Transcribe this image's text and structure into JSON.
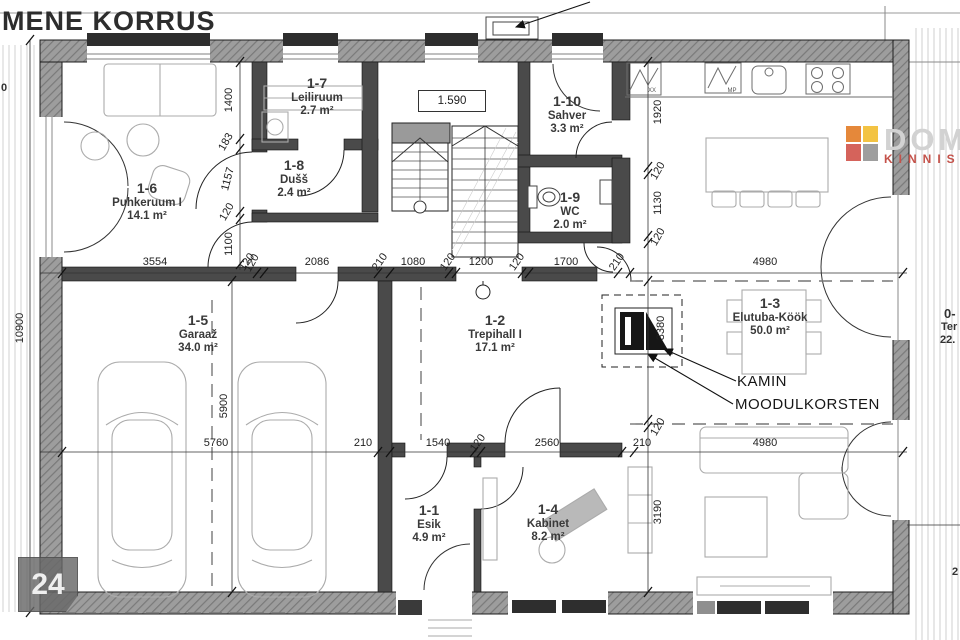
{
  "title": "MENE KORRUS",
  "page_badge": "24",
  "logo": {
    "name": "DOM",
    "subtitle": "KINNIS",
    "squares": [
      "#e5883a",
      "#f3c343",
      "#d5635b",
      "#9e9e9e"
    ]
  },
  "annotations": {
    "kamin": "KAMIN",
    "moodulkorsten": "MOODULKORSTEN",
    "stair_level": "1.590"
  },
  "partials": {
    "top_left_dim": "0",
    "terrace_id": "0-",
    "terrace_name": "Ter",
    "terrace_area": "22.",
    "bottom_right_dim": "2"
  },
  "rooms": [
    {
      "id": "1-1",
      "name": "Esik",
      "area": "4.9 m²",
      "x": 429,
      "y": 503
    },
    {
      "id": "1-2",
      "name": "Trepihall I",
      "area": "17.1 m²",
      "x": 495,
      "y": 313
    },
    {
      "id": "1-3",
      "name": "Elutuba-Köök",
      "area": "50.0 m²",
      "x": 770,
      "y": 296
    },
    {
      "id": "1-4",
      "name": "Kabinet",
      "area": "8.2 m²",
      "x": 548,
      "y": 502
    },
    {
      "id": "1-5",
      "name": "Garaaž",
      "area": "34.0 m²",
      "x": 198,
      "y": 313
    },
    {
      "id": "1-6",
      "name": "Puhkeruum I",
      "area": "14.1 m²",
      "x": 147,
      "y": 181
    },
    {
      "id": "1-7",
      "name": "Leiliruum",
      "area": "2.7 m²",
      "x": 317,
      "y": 76
    },
    {
      "id": "1-8",
      "name": "Dušš",
      "area": "2.4 m²",
      "x": 294,
      "y": 158
    },
    {
      "id": "1-9",
      "name": "WC",
      "area": "2.0 m²",
      "x": 570,
      "y": 190
    },
    {
      "id": "1-10",
      "name": "Sahver",
      "area": "3.3 m²",
      "x": 567,
      "y": 94
    }
  ],
  "dim_labels": [
    {
      "t": "3554",
      "x": 155,
      "y": 262,
      "r": 0
    },
    {
      "t": "120",
      "x": 247,
      "y": 262,
      "r": -55
    },
    {
      "t": "2086",
      "x": 317,
      "y": 262,
      "r": 0
    },
    {
      "t": "210",
      "x": 380,
      "y": 262,
      "r": -55
    },
    {
      "t": "1080",
      "x": 413,
      "y": 262,
      "r": 0
    },
    {
      "t": "120",
      "x": 448,
      "y": 262,
      "r": -55
    },
    {
      "t": "1200",
      "x": 481,
      "y": 262,
      "r": 0
    },
    {
      "t": "120",
      "x": 517,
      "y": 262,
      "r": -55
    },
    {
      "t": "1700",
      "x": 566,
      "y": 262,
      "r": 0
    },
    {
      "t": "210",
      "x": 617,
      "y": 262,
      "r": -55
    },
    {
      "t": "4980",
      "x": 765,
      "y": 262,
      "r": 0
    },
    {
      "t": "5760",
      "x": 216,
      "y": 443,
      "r": 0
    },
    {
      "t": "210",
      "x": 363,
      "y": 443,
      "r": 0
    },
    {
      "t": "1540",
      "x": 438,
      "y": 443,
      "r": 0
    },
    {
      "t": "120",
      "x": 478,
      "y": 443,
      "r": -55
    },
    {
      "t": "2560",
      "x": 547,
      "y": 443,
      "r": 0
    },
    {
      "t": "210",
      "x": 642,
      "y": 443,
      "r": 0
    },
    {
      "t": "4980",
      "x": 765,
      "y": 443,
      "r": 0
    },
    {
      "t": "1400",
      "x": 229,
      "y": 100,
      "r": -90
    },
    {
      "t": "183",
      "x": 226,
      "y": 142,
      "r": -60
    },
    {
      "t": "1157",
      "x": 228,
      "y": 179,
      "r": -75
    },
    {
      "t": "120",
      "x": 227,
      "y": 212,
      "r": -60
    },
    {
      "t": "1100",
      "x": 229,
      "y": 244,
      "r": -90
    },
    {
      "t": "120",
      "x": 252,
      "y": 263,
      "r": -60
    },
    {
      "t": "10900",
      "x": 20,
      "y": 328,
      "r": -90
    },
    {
      "t": "5900",
      "x": 224,
      "y": 406,
      "r": -90
    },
    {
      "t": "1920",
      "x": 658,
      "y": 112,
      "r": -90
    },
    {
      "t": "120",
      "x": 658,
      "y": 171,
      "r": -60
    },
    {
      "t": "1130",
      "x": 658,
      "y": 203,
      "r": -90
    },
    {
      "t": "120",
      "x": 658,
      "y": 237,
      "r": -60
    },
    {
      "t": "3380",
      "x": 661,
      "y": 328,
      "r": -90
    },
    {
      "t": "120",
      "x": 658,
      "y": 427,
      "r": -60
    },
    {
      "t": "3190",
      "x": 658,
      "y": 512,
      "r": -90
    }
  ],
  "tiny_labels": [
    {
      "t": "XX",
      "x": 652,
      "y": 91
    },
    {
      "t": "MP",
      "x": 732,
      "y": 91
    }
  ]
}
